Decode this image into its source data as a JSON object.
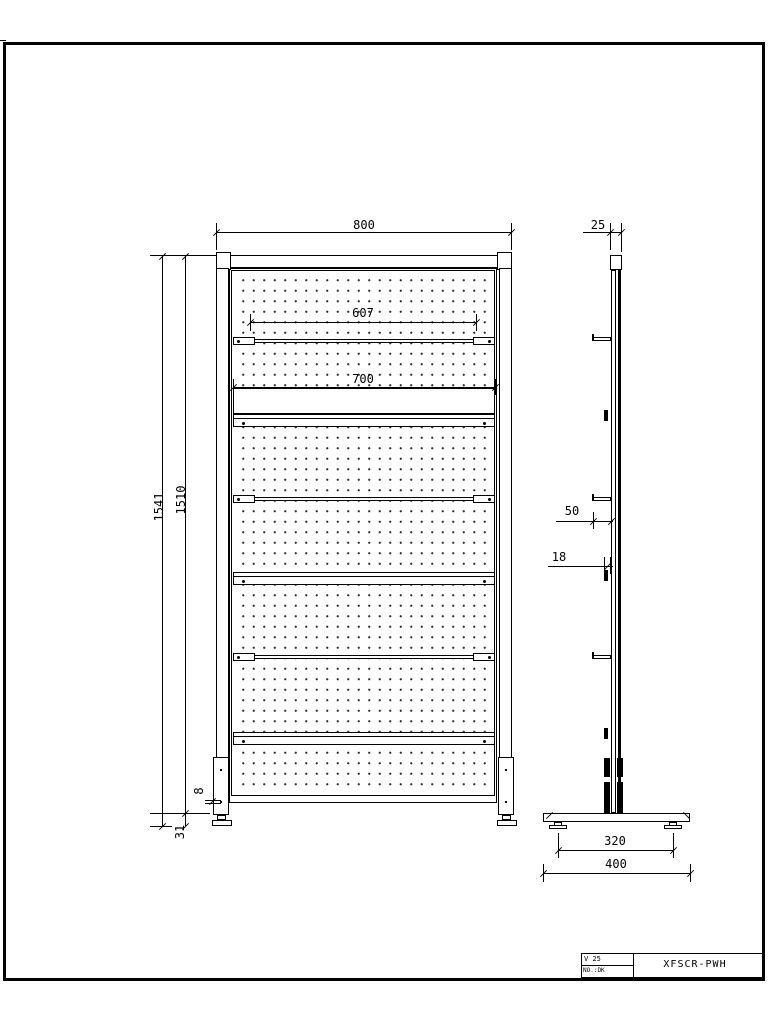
{
  "sheet": {
    "front_view": {
      "dim_width": "800",
      "dim_hook_rail": "607",
      "dim_shelf": "700",
      "dim_total_height": "1541",
      "dim_panel_height": "1510",
      "dim_bottom_gap": "8",
      "dim_foot_height": "31"
    },
    "side_view": {
      "dim_thickness": "25",
      "dim_hook_depth": "50",
      "dim_bracket_depth": "18",
      "dim_foot_spacing": "320",
      "dim_base_width": "400"
    },
    "title_block": {
      "rev": "V 25",
      "doc_no": "NO.:DK",
      "title": "XFSCR-PWH"
    },
    "colors": {
      "line": "#000000",
      "paper": "#ffffff"
    }
  }
}
